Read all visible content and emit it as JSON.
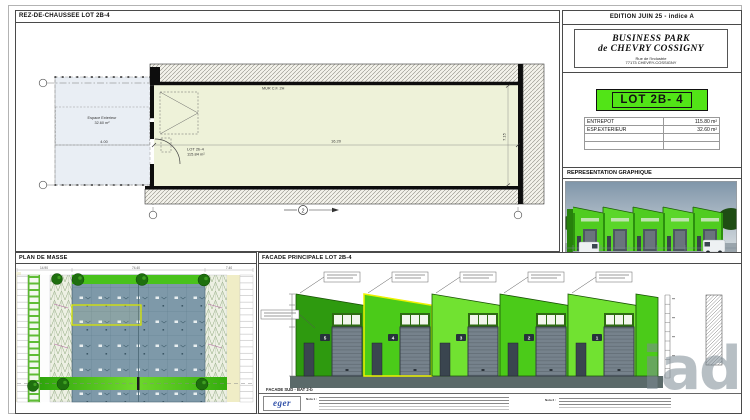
{
  "floor_plan": {
    "panel_title": "REZ-DE-CHAUSSEE LOT 2B-4",
    "wall_label": "MUR C.F. 2H",
    "lot_label": "LOT 2b-4",
    "lot_area": "115.84 m²",
    "exterior_label": "Espace Exterieur",
    "exterior_area": "32.60 m²",
    "dim_length": "16.20",
    "dim_depth": "7.15",
    "dim_exterior": "4.00",
    "axis_label": "2"
  },
  "title_block": {
    "edition": "EDITION JUIN 25 - indice A",
    "project_name_line1": "BUSINESS PARK",
    "project_name_line2": "de CHEVRY COSSIGNY",
    "address_line1": "Rue de l'Industrie",
    "address_line2": "77173 CHEVRY-COSSIGNY",
    "lot_banner": "LOT 2B- 4",
    "surface_table": {
      "rows": [
        {
          "label": "ENTREPOT",
          "value": "115.80 m²"
        },
        {
          "label": "ESP.EXTERIEUR",
          "value": "32.60 m²"
        }
      ]
    },
    "representation_title": "REPRESENTATION GRAPHIQUE"
  },
  "site_plan": {
    "panel_title": "PLAN DE MASSE",
    "dim_left": "14.90",
    "dim_center": "74.40",
    "dim_right": "7.40"
  },
  "facade": {
    "panel_title": "FACADE PRINCIPALE LOT 2B-4",
    "caption": "FACADE SUD - BAT 2-b",
    "unit_numbers": [
      "5",
      "4",
      "3",
      "2",
      "1"
    ]
  },
  "footer": {
    "logo_text": "eger",
    "note1_label": "Nota 1 :",
    "note2_label": "Nota 2 :"
  },
  "watermark": "iad",
  "colors": {
    "lot_green": "#52e417",
    "facade_green_dark": "#2e9a0f",
    "facade_green_bright": "#4bcb19",
    "facade_green_light": "#71e231",
    "site_building_blue": "#7e99a9",
    "landscape_green": "#49c21b",
    "hall_fill": "#eef2d9"
  }
}
